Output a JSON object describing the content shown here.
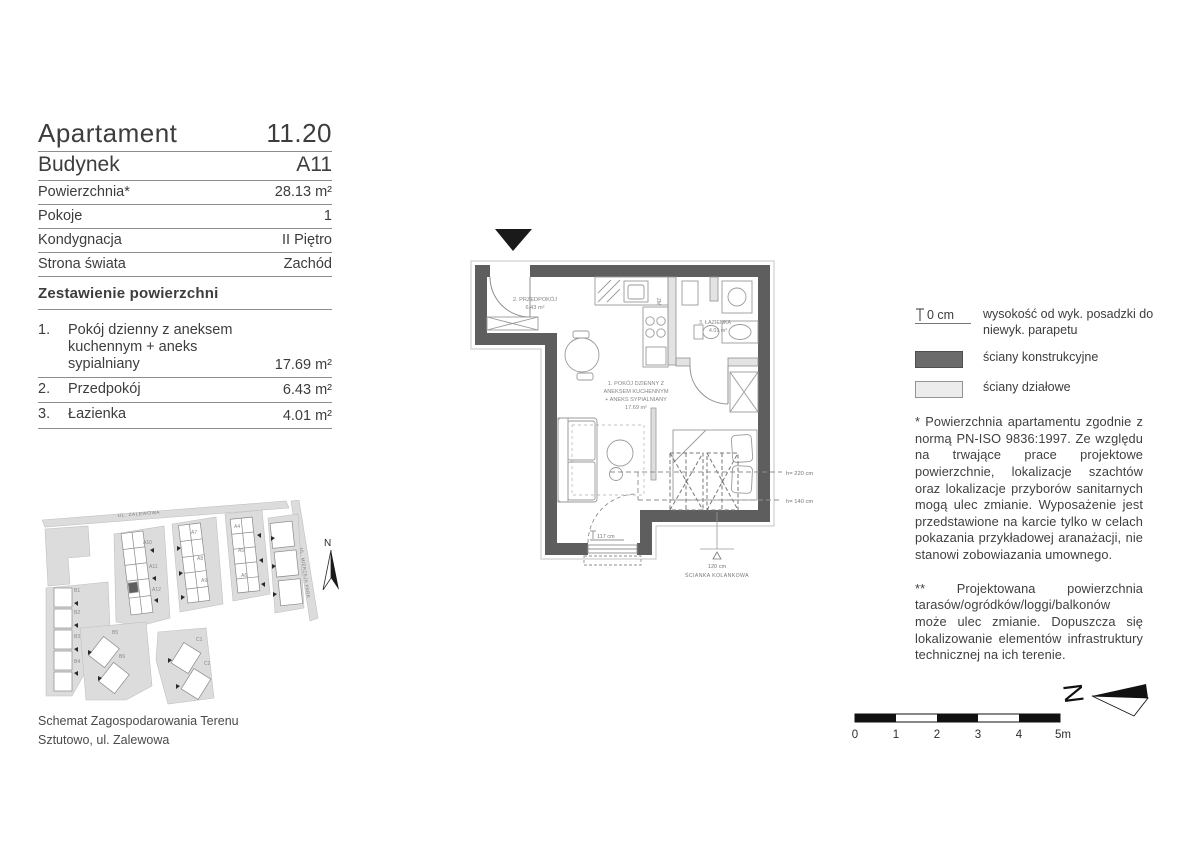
{
  "header": {
    "rows": [
      {
        "label": "Apartament",
        "value": "11.20"
      },
      {
        "label": "Budynek",
        "value": "A11"
      },
      {
        "label": "Powierzchnia*",
        "value": "28.13 m²"
      },
      {
        "label": "Pokoje",
        "value": "1"
      },
      {
        "label": "Kondygnacja",
        "value": "II Piętro"
      },
      {
        "label": "Strona świata",
        "value": "Zachód"
      }
    ]
  },
  "area_table": {
    "title": "Zestawienie powierzchni",
    "rows": [
      {
        "num": "1.",
        "line1": "Pokój dzienny z aneksem",
        "line2": "kuchennym + aneks",
        "line3": "sypialniany",
        "value": "17.69 m²"
      },
      {
        "num": "2.",
        "line1": "Przedpokój",
        "value": "6.43 m²"
      },
      {
        "num": "3.",
        "line1": "Łazienka",
        "value": "4.01 m²"
      }
    ]
  },
  "floor_plan": {
    "labels": {
      "przedpokoj_1": "2. PRZEDPOKÓJ",
      "przedpokoj_2": "6.43 m²",
      "lazienka_1": "3. ŁAZIENKA",
      "lazienka_2": "4.01 m²",
      "pokoj_1": "1. POKÓJ DZIENNY Z",
      "pokoj_2": "ANEKSEM KUCHENNYM",
      "pokoj_3": "+ ANEKS SYPIALNIANY",
      "pokoj_4": "17.69 m²",
      "zm": "ZM",
      "window_height": "117 cm",
      "h220": "h= 220 cm",
      "h140": "h= 140 cm",
      "knee_height": "120 cm",
      "knee_label": "ŚCIANKA KOLANKOWA"
    }
  },
  "legend": {
    "items": [
      {
        "key_text": "0 cm",
        "label": "wysokość od wyk. posadzki do niewyk. parapetu"
      },
      {
        "label": "ściany konstrukcyjne"
      },
      {
        "label": "ściany działowe"
      }
    ]
  },
  "notes": [
    "*  Powierzchnia apartamentu zgodnie z normą PN-ISO 9836:1997. Ze względu na trwające prace projektowe powierzchnie, lokalizacje szachtów oraz lokalizacje przyborów sanitarnych mogą ulec zmianie. Wyposażenie jest przedstawione na karcie tylko w celach pokazania przykładowej aranażacji, nie stanowi zobowiazania umownego.",
    "**  Projektowana powierzchnia tarasów/ogródków/loggi/balkonów może ulec zmianie. Dopuszcza się lokalizowanie elementów infrastruktury technicznej na ich terenie."
  ],
  "site_plan": {
    "caption_line1": "Schemat Zagospodarowania Terenu",
    "caption_line2": "Sztutowo, ul. Zalewowa",
    "street_top": "UL. ZALEWOWA",
    "street_right": "UL. MIERZEJA PARK",
    "buildings": {
      "a10": "A10",
      "a11": "A11",
      "a12": "A12",
      "a7": "A7",
      "a8": "A8",
      "a9": "A9",
      "a4": "A4",
      "a5": "A5",
      "a6": "A6",
      "b1": "B1",
      "b2": "B2",
      "b3": "B3",
      "b4": "B4",
      "b5": "B5",
      "b6": "B6",
      "c1": "C1",
      "c2": "C2"
    }
  },
  "scale_bar": {
    "ticks": [
      "0",
      "1",
      "2",
      "3",
      "4",
      "5m"
    ]
  },
  "compass": {
    "letter": "N"
  },
  "colors": {
    "wall_structural": "#5e5e5e",
    "wall_partition": "#e3e3e3",
    "line": "#8f8f8f",
    "text": "#3d3d3d"
  }
}
